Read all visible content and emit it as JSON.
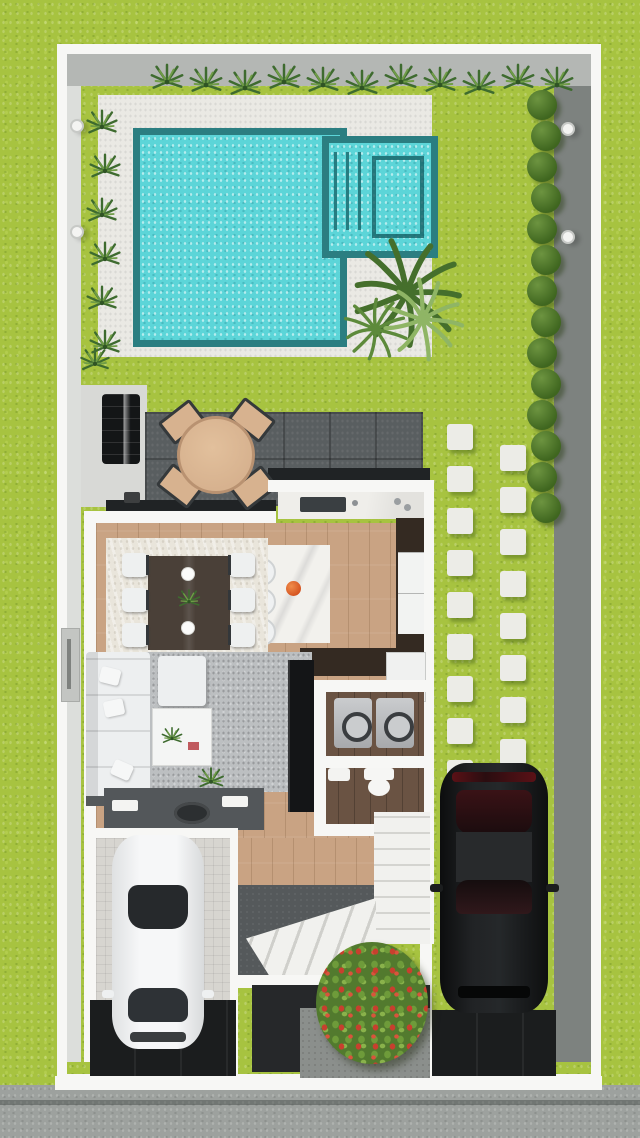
{
  "scene": {
    "description": "Top-down 3D architectural render of a narrow-lot two-car house plan with backyard pool",
    "areas": {
      "pool": "Swimming pool with spa and entry steps",
      "pool_deck": "White paved pool deck",
      "lawn": "Lawn / garden",
      "patio": "Covered outdoor patio with dining set and grill",
      "kitchen": "Kitchen with island and three stools",
      "dining": "Indoor dining area with six chairs",
      "living": "Living room with sectional sofa",
      "laundry": "Laundry room with two washers",
      "bathroom": "Bathroom with toilet and sink",
      "hall": "Hallway vanity counter",
      "stairs": "L-shaped staircase",
      "entry": "Entry court with flowering bush",
      "garage": "Single garage with white car",
      "carport": "Grass paver parking with black car",
      "street": "Street and sidewalk with curb"
    },
    "furniture": [
      "bbq-grill",
      "round-patio-table",
      "patio-chair x4",
      "potted-plant",
      "dining-table",
      "dining-chair x6",
      "dinner-plate x2",
      "centerpiece-plant",
      "kitchen-island",
      "bar-stool x3",
      "fruit-bowl",
      "kitchen-sink",
      "refrigerator",
      "sectional-sofa",
      "chaise",
      "throw-pillow x3",
      "coffee-table",
      "book",
      "tv-wall-unit",
      "washer x2",
      "toilet",
      "bathroom-sink",
      "vanity-basin",
      "wall-ac-unit",
      "wall-light x4"
    ],
    "vehicles": [
      {
        "name": "white-sedan",
        "location": "garage"
      },
      {
        "name": "black-suv",
        "location": "grass paver driveway"
      }
    ]
  },
  "palette": {
    "grass": "#a7c340",
    "deck": "#eae9e4",
    "pool_water": "#5cd5d8",
    "pool_coping": "#2b7e81",
    "patio_tile": "#595e60",
    "wood_floor": "#c9a383",
    "dark_wood": "#6a5343",
    "wall_white": "#f7f7f5",
    "wall_gray": "#b4b7b4",
    "wall_dark": "#7d827f",
    "street": "#9da19e",
    "driveway": "#1b1d1e",
    "rug_cream": "#e9e5db",
    "rug_gray": "#bcbfc1",
    "cabinet_brown": "#342a22",
    "sofa_white": "#edeff0",
    "table_wood": "#d7b28f",
    "hedge_green": "#3f661f",
    "plant_green": "#3e6b2f",
    "flower_red": "#c7402e"
  },
  "generated": {
    "top_plants": {
      "count": 11,
      "x0": 148,
      "dx": 39,
      "y": 62
    },
    "left_plants": {
      "count": 6,
      "x": 84,
      "y0": 108,
      "dy": 44
    },
    "extra_plants": [
      [
        78,
        346
      ],
      [
        104,
        455
      ],
      [
        196,
        766
      ],
      [
        310,
        462
      ]
    ],
    "hedge": {
      "count": 14,
      "x": 527,
      "y0": 90,
      "dy": 31
    },
    "stones": {
      "size": 26,
      "dy": 42,
      "cols": [
        {
          "x": 447,
          "y0": 424,
          "count": 9
        },
        {
          "x": 500,
          "y0": 445,
          "count": 9
        }
      ]
    },
    "wall_lights": [
      [
        70,
        119
      ],
      [
        70,
        225
      ],
      [
        561,
        122
      ],
      [
        561,
        230
      ]
    ]
  }
}
